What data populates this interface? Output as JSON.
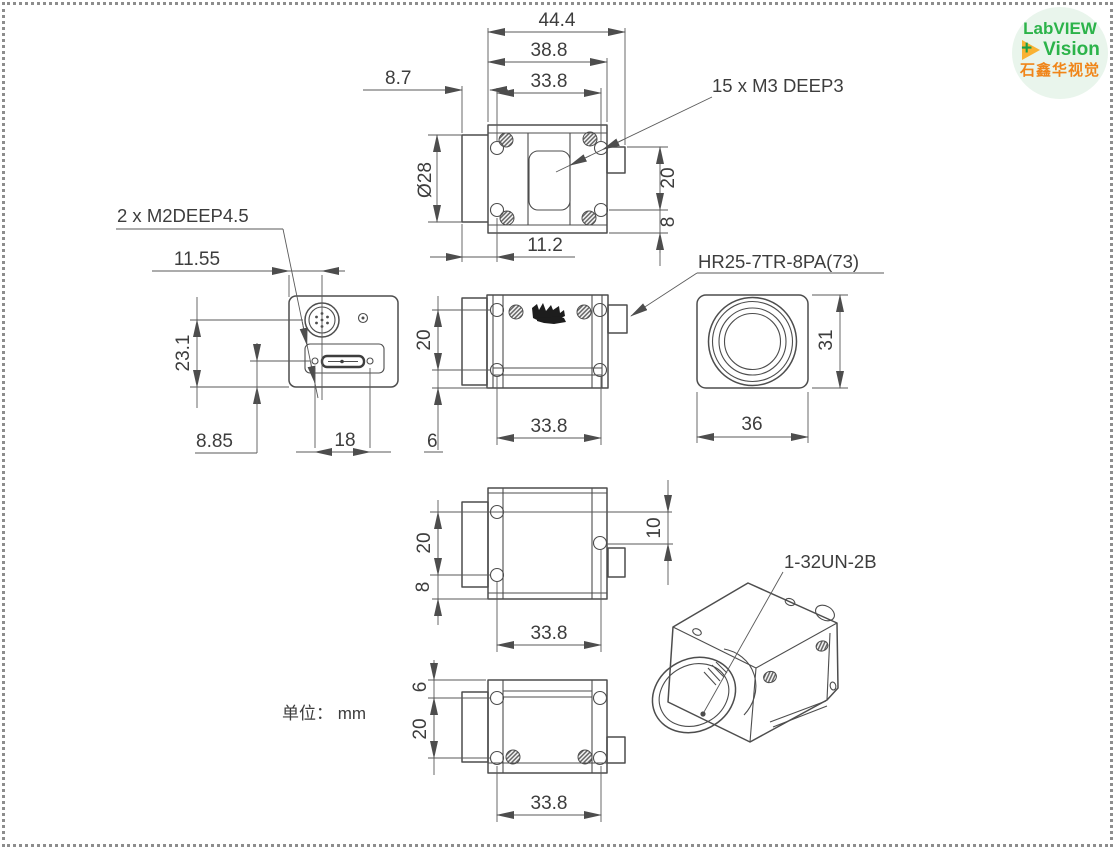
{
  "unit_label": "单位： mm",
  "logo": {
    "line1": "LabVIEW",
    "line2": "Vision",
    "line3": "石鑫华视觉",
    "plus": "+"
  },
  "callouts": {
    "screw_top": "15 x  M3 DEEP3",
    "screw_back": "2 x  M2DEEP4.5",
    "connector": "HR25-7TR-8PA(73)",
    "lens_thread": "1-32UN-2B"
  },
  "dims": {
    "top": {
      "overall": "44.4",
      "body": "38.8",
      "holes": "33.8",
      "lens_protrusion": "8.7",
      "lens_dia": "Ø28",
      "conn": "20",
      "edge": "8",
      "front": "11.2"
    },
    "back": {
      "conn_offset": "11.55",
      "conn_height": "23.1",
      "usb_offset": "8.85",
      "screw_pitch": "18"
    },
    "side": {
      "hole_pitch": "20",
      "edge": "6",
      "hole_span": "33.8"
    },
    "front": {
      "height": "31",
      "width": "36"
    },
    "side2": {
      "hole_pitch": "20",
      "edge": "8",
      "conn_offset": "10",
      "hole_span": "33.8"
    },
    "bottom": {
      "edge": "6",
      "hole_pitch": "20",
      "hole_span": "33.8"
    }
  },
  "colors": {
    "line": "#4d4d4d",
    "logo_green": "#2cb34a",
    "logo_orange_text": "#f08519",
    "logo_arrow": "#f9b233"
  }
}
